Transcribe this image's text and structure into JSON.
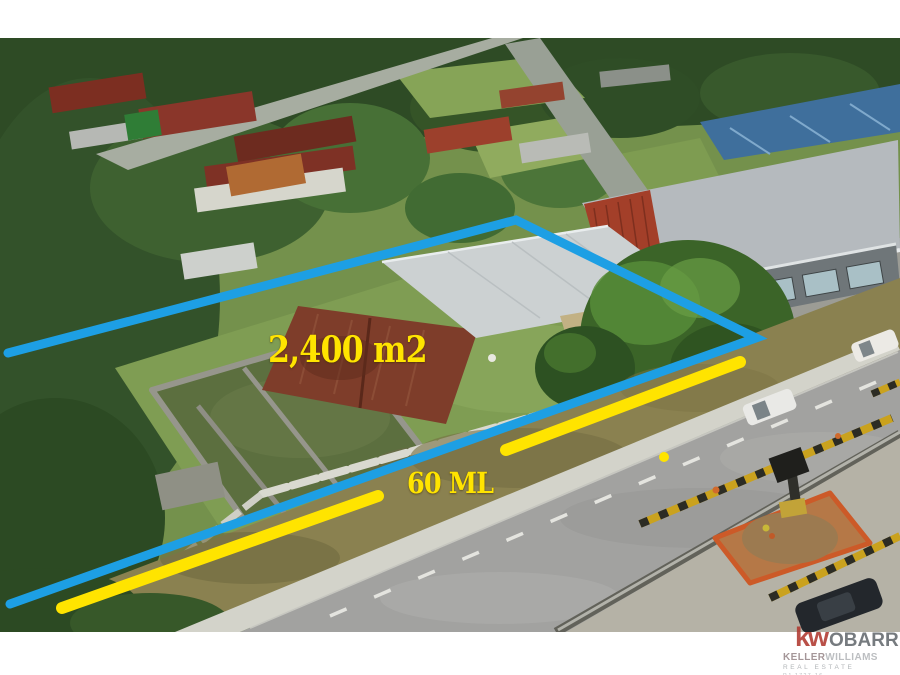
{
  "colors": {
    "boundary_blue": "#1d9fe4",
    "highlight_yellow": "#ffe400",
    "kw_red": "#b0392f",
    "wm_gray": "#64696e"
  },
  "annotations": {
    "area_label": "2,400 m2",
    "frontage_label": "60 ML"
  },
  "watermark": {
    "logo": "kw",
    "brand": "OBARRIO",
    "company_bold": "KELLER",
    "company_light": "WILLIAMS",
    "tagline": "REAL ESTATE",
    "license": "PJ-1727-16"
  }
}
